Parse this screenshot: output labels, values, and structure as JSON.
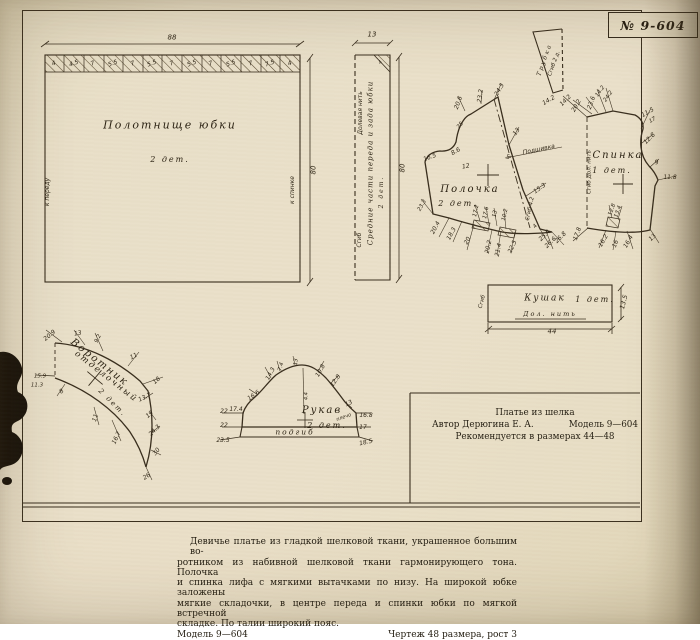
{
  "sheet_no": "№ 9-604",
  "caption": {
    "line1": "Платье из шелка",
    "line2_left": "Автор Дерюгина Е. А.",
    "line2_right": "Модель 9—604",
    "line3": "Рекомендуется в размерах 44—48"
  },
  "footer": {
    "lines": [
      "Девичье платье из гладкой шелковой ткани, украшенное большим во-",
      "ротником из набивной шелковой ткани гармонирующего тона. Полочка",
      "и спинка лифа с мягкими вытачками по низу. На широкой юбке заложены",
      "мягкие складочки, в центре переда и спинки юбки по мягкой встречной",
      "складке. По талии широкий пояс."
    ],
    "model_left": "Модель 9—604",
    "drawing_right": "Чертеж 48 размера, рост 3"
  },
  "colors": {
    "paper": "#e9dfc8",
    "ink": "#372c1c"
  },
  "annotations": [
    {
      "t": "88",
      "x": 172,
      "y": 38,
      "fs": 7,
      "n": "dim-skirt-width"
    },
    {
      "t": "4",
      "x": 54,
      "y": 64,
      "r": -20,
      "fs": 6
    },
    {
      "t": "4.5",
      "x": 74,
      "y": 64,
      "r": -20,
      "fs": 6
    },
    {
      "t": "7",
      "x": 93,
      "y": 64,
      "r": -20,
      "fs": 6
    },
    {
      "t": "5.5",
      "x": 113,
      "y": 64,
      "r": -20,
      "fs": 6
    },
    {
      "t": "7",
      "x": 133,
      "y": 64,
      "r": -20,
      "fs": 6
    },
    {
      "t": "5.5",
      "x": 152,
      "y": 64,
      "r": -20,
      "fs": 6
    },
    {
      "t": "7",
      "x": 172,
      "y": 64,
      "r": -20,
      "fs": 6
    },
    {
      "t": "5.5",
      "x": 192,
      "y": 64,
      "r": -20,
      "fs": 6
    },
    {
      "t": "7",
      "x": 211,
      "y": 64,
      "r": -20,
      "fs": 6
    },
    {
      "t": "5.5",
      "x": 231,
      "y": 64,
      "r": -20,
      "fs": 6
    },
    {
      "t": "7",
      "x": 251,
      "y": 64,
      "r": -20,
      "fs": 6
    },
    {
      "t": "7.5",
      "x": 270,
      "y": 64,
      "r": -20,
      "fs": 6
    },
    {
      "t": "4",
      "x": 290,
      "y": 64,
      "r": -20,
      "fs": 6
    },
    {
      "t": "Полотнище юбки",
      "x": 170,
      "y": 125,
      "fs": 11,
      "c": "pc",
      "n": "piece-skirt-panel"
    },
    {
      "t": "2 дет.",
      "x": 170,
      "y": 160,
      "fs": 8,
      "c": "pc"
    },
    {
      "t": "к переду",
      "x": 48,
      "y": 192,
      "r": -90,
      "fs": 6
    },
    {
      "t": "к спинке",
      "x": 293,
      "y": 190,
      "r": -90,
      "fs": 6
    },
    {
      "t": "80",
      "x": 314,
      "y": 170,
      "r": -90,
      "fs": 7,
      "n": "dim-skirt-length"
    },
    {
      "t": "13",
      "x": 372,
      "y": 35,
      "fs": 7,
      "n": "dim-strip-width"
    },
    {
      "t": "4",
      "x": 381,
      "y": 63,
      "r": -45,
      "fs": 5
    },
    {
      "t": "Долевая нить",
      "x": 361,
      "y": 113,
      "r": -90,
      "fs": 6
    },
    {
      "t": "Сгиб",
      "x": 360,
      "y": 240,
      "r": -90,
      "fs": 6
    },
    {
      "t": "Средние части переда и зада юбки",
      "x": 371,
      "y": 163,
      "r": -90,
      "fs": 7,
      "c": "pc2",
      "n": "piece-skirt-middle"
    },
    {
      "t": "2 дет.",
      "x": 382,
      "y": 192,
      "r": -90,
      "fs": 6,
      "c": "pc"
    },
    {
      "t": "80",
      "x": 403,
      "y": 168,
      "r": -90,
      "fs": 7
    },
    {
      "t": "Полочка",
      "x": 470,
      "y": 190,
      "fs": 10,
      "c": "pc",
      "n": "piece-front-bodice"
    },
    {
      "t": "2 дет.",
      "x": 458,
      "y": 204,
      "fs": 8,
      "c": "pc"
    },
    {
      "t": "20.6",
      "x": 459,
      "y": 103,
      "r": -70,
      "fs": 6
    },
    {
      "t": "23.2",
      "x": 481,
      "y": 96,
      "r": -82,
      "fs": 6
    },
    {
      "t": "24.3",
      "x": 500,
      "y": 90,
      "r": -60,
      "fs": 6
    },
    {
      "t": "25",
      "x": 461,
      "y": 126,
      "r": -50,
      "fs": 5.5
    },
    {
      "t": "8.6",
      "x": 456,
      "y": 152,
      "r": -30,
      "fs": 6
    },
    {
      "t": "16.5",
      "x": 430,
      "y": 158,
      "r": -20,
      "fs": 6
    },
    {
      "t": "12",
      "x": 466,
      "y": 167,
      "r": -10,
      "fs": 6
    },
    {
      "t": "13",
      "x": 517,
      "y": 132,
      "r": -55,
      "fs": 6
    },
    {
      "t": "5",
      "x": 508,
      "y": 158,
      "fs": 6
    },
    {
      "t": "Подшивка",
      "x": 539,
      "y": 150,
      "r": -12,
      "fs": 6,
      "n": "label-hem-facing"
    },
    {
      "t": "15.3",
      "x": 540,
      "y": 189,
      "r": -35,
      "fs": 6
    },
    {
      "t": "Сгиб 4.2",
      "x": 531,
      "y": 209,
      "r": -78,
      "fs": 5.5
    },
    {
      "t": "23.3",
      "x": 423,
      "y": 206,
      "r": -60,
      "fs": 5.5
    },
    {
      "t": "20.4",
      "x": 436,
      "y": 228,
      "r": -62,
      "fs": 6
    },
    {
      "t": "18.3",
      "x": 452,
      "y": 234,
      "r": -62,
      "fs": 6
    },
    {
      "t": "20",
      "x": 468,
      "y": 241,
      "r": -62,
      "fs": 6
    },
    {
      "t": "17.2",
      "x": 477,
      "y": 211,
      "r": -78,
      "fs": 5.5
    },
    {
      "t": "17.6",
      "x": 487,
      "y": 213,
      "r": -78,
      "fs": 5.5
    },
    {
      "t": "13",
      "x": 496,
      "y": 214,
      "r": -78,
      "fs": 5.5
    },
    {
      "t": "10.2",
      "x": 506,
      "y": 215,
      "r": -78,
      "fs": 5.5
    },
    {
      "t": "20.2",
      "x": 489,
      "y": 247,
      "r": -78,
      "fs": 6
    },
    {
      "t": "21.4",
      "x": 499,
      "y": 250,
      "r": -78,
      "fs": 6
    },
    {
      "t": "22.5",
      "x": 513,
      "y": 247,
      "r": -65,
      "fs": 6
    },
    {
      "t": "4",
      "x": 536,
      "y": 227,
      "r": -50,
      "fs": 5.5
    },
    {
      "t": "25.4",
      "x": 545,
      "y": 236,
      "r": -45,
      "fs": 6
    },
    {
      "t": "26.6",
      "x": 551,
      "y": 243,
      "r": -45,
      "fs": 6
    },
    {
      "t": "26.8",
      "x": 561,
      "y": 238,
      "r": -45,
      "fs": 6
    },
    {
      "t": "Трубка",
      "x": 545,
      "y": 60,
      "r": -70,
      "fs": 6,
      "c": "pc",
      "n": "piece-rouleau"
    },
    {
      "t": "Сгиб 2 д.",
      "x": 555,
      "y": 64,
      "r": -70,
      "fs": 5.5
    },
    {
      "t": "14.2",
      "x": 549,
      "y": 101,
      "r": -30,
      "fs": 6
    },
    {
      "t": "14.2",
      "x": 566,
      "y": 101,
      "r": -45,
      "fs": 6
    },
    {
      "t": "20.2",
      "x": 577,
      "y": 106,
      "r": -60,
      "fs": 6
    },
    {
      "t": "23.6",
      "x": 592,
      "y": 103,
      "r": -70,
      "fs": 6
    },
    {
      "t": "14.2",
      "x": 601,
      "y": 92,
      "r": -55,
      "fs": 5.5
    },
    {
      "t": "24.2",
      "x": 609,
      "y": 97,
      "r": -55,
      "fs": 5.5
    },
    {
      "t": "Спинка",
      "x": 618,
      "y": 156,
      "fs": 10,
      "c": "pc",
      "n": "piece-back"
    },
    {
      "t": "1 дет.",
      "x": 612,
      "y": 171,
      "fs": 8,
      "c": "pc"
    },
    {
      "t": "Сгиб  Дол. нить",
      "x": 590,
      "y": 172,
      "r": -90,
      "fs": 5.5
    },
    {
      "t": "11.5",
      "x": 648,
      "y": 113,
      "r": -30,
      "fs": 6
    },
    {
      "t": "17",
      "x": 653,
      "y": 121,
      "r": -30,
      "fs": 5.5
    },
    {
      "t": "12.8",
      "x": 650,
      "y": 139,
      "r": -45,
      "fs": 6
    },
    {
      "t": "9",
      "x": 657,
      "y": 163,
      "r": -15,
      "fs": 6
    },
    {
      "t": "11.8",
      "x": 670,
      "y": 178,
      "fs": 6
    },
    {
      "t": "12.8",
      "x": 613,
      "y": 210,
      "r": -70,
      "fs": 5.5
    },
    {
      "t": "13.4",
      "x": 619,
      "y": 212,
      "r": -70,
      "fs": 5.5
    },
    {
      "t": "17.8",
      "x": 578,
      "y": 234,
      "r": -70,
      "fs": 6
    },
    {
      "t": "16.2",
      "x": 604,
      "y": 241,
      "r": -60,
      "fs": 6
    },
    {
      "t": "16",
      "x": 616,
      "y": 244,
      "r": -70,
      "fs": 6
    },
    {
      "t": "16.4",
      "x": 629,
      "y": 242,
      "r": -60,
      "fs": 6
    },
    {
      "t": "13",
      "x": 653,
      "y": 238,
      "r": -45,
      "fs": 6
    },
    {
      "t": "Кушак",
      "x": 545,
      "y": 299,
      "fs": 9,
      "c": "pc",
      "n": "piece-sash"
    },
    {
      "t": "1 дет.",
      "x": 595,
      "y": 300,
      "fs": 8,
      "c": "pc"
    },
    {
      "t": "Дол. нить",
      "x": 550,
      "y": 314,
      "fs": 6.5,
      "c": "pc",
      "n": "label-grain-line"
    },
    {
      "t": "44",
      "x": 552,
      "y": 332,
      "fs": 7,
      "n": "dim-sash-length"
    },
    {
      "t": "13.5",
      "x": 624,
      "y": 302,
      "r": -75,
      "fs": 6.5,
      "n": "dim-sash-width"
    },
    {
      "t": "Сгиб",
      "x": 483,
      "y": 302,
      "r": -75,
      "fs": 5.5
    },
    {
      "t": "Воротник",
      "x": 99,
      "y": 363,
      "r": 38,
      "fs": 10,
      "c": "pc",
      "n": "piece-collar"
    },
    {
      "t": "отделочный",
      "x": 106,
      "y": 377,
      "r": 38,
      "fs": 8.5,
      "c": "pc"
    },
    {
      "t": "2 дет.",
      "x": 112,
      "y": 403,
      "r": 45,
      "fs": 7,
      "c": "pc"
    },
    {
      "t": "20.9",
      "x": 50,
      "y": 336,
      "r": -40,
      "fs": 6
    },
    {
      "t": "13",
      "x": 78,
      "y": 334,
      "r": -10,
      "fs": 6
    },
    {
      "t": "9.2",
      "x": 99,
      "y": 339,
      "r": -65,
      "fs": 5.5
    },
    {
      "t": "11",
      "x": 134,
      "y": 357,
      "r": -25,
      "fs": 6
    },
    {
      "t": "18",
      "x": 157,
      "y": 381,
      "r": -40,
      "fs": 6
    },
    {
      "t": "13.7",
      "x": 145,
      "y": 398,
      "r": -25,
      "fs": 6
    },
    {
      "t": "19",
      "x": 150,
      "y": 415,
      "r": -40,
      "fs": 6
    },
    {
      "t": "24.3",
      "x": 155,
      "y": 431,
      "r": -45,
      "fs": 6
    },
    {
      "t": "30",
      "x": 157,
      "y": 452,
      "r": -50,
      "fs": 6
    },
    {
      "t": "26",
      "x": 147,
      "y": 477,
      "r": -35,
      "fs": 6
    },
    {
      "t": "15.9",
      "x": 40,
      "y": 377,
      "fs": 5.5
    },
    {
      "t": "11.3",
      "x": 37,
      "y": 386,
      "fs": 5.5
    },
    {
      "t": "8",
      "x": 62,
      "y": 392,
      "r": -35,
      "fs": 6
    },
    {
      "t": "11",
      "x": 96,
      "y": 418,
      "r": -72,
      "fs": 6
    },
    {
      "t": "16.7",
      "x": 117,
      "y": 438,
      "r": -65,
      "fs": 6
    },
    {
      "t": "Рукав",
      "x": 322,
      "y": 411,
      "fs": 10,
      "c": "pc",
      "n": "piece-sleeve"
    },
    {
      "t": "2 дет.",
      "x": 327,
      "y": 426,
      "fs": 8,
      "c": "pc"
    },
    {
      "t": "подгиб",
      "x": 295,
      "y": 432,
      "fs": 7.5,
      "c": "pc",
      "n": "label-hem"
    },
    {
      "t": "14.3",
      "x": 271,
      "y": 374,
      "r": -62,
      "fs": 6
    },
    {
      "t": "7.4",
      "x": 282,
      "y": 367,
      "r": -75,
      "fs": 5.5
    },
    {
      "t": "13",
      "x": 297,
      "y": 362,
      "r": -85,
      "fs": 5.5
    },
    {
      "t": "10.8",
      "x": 321,
      "y": 371,
      "r": -60,
      "fs": 6
    },
    {
      "t": "12.8",
      "x": 336,
      "y": 381,
      "r": -55,
      "fs": 6
    },
    {
      "t": "13",
      "x": 349,
      "y": 404,
      "r": -25,
      "fs": 6
    },
    {
      "t": "16.6",
      "x": 254,
      "y": 396,
      "r": -35,
      "fs": 6
    },
    {
      "t": "17.4",
      "x": 236,
      "y": 410,
      "fs": 6
    },
    {
      "t": "22",
      "x": 224,
      "y": 412,
      "fs": 6
    },
    {
      "t": "22",
      "x": 224,
      "y": 426,
      "fs": 6
    },
    {
      "t": "23.5",
      "x": 223,
      "y": 441,
      "fs": 6
    },
    {
      "t": "плечо",
      "x": 344,
      "y": 418,
      "r": -20,
      "fs": 5
    },
    {
      "t": "16.8",
      "x": 366,
      "y": 416,
      "fs": 6
    },
    {
      "t": "17",
      "x": 363,
      "y": 428,
      "fs": 6
    },
    {
      "t": "18.5",
      "x": 366,
      "y": 443,
      "r": -12,
      "fs": 6
    },
    {
      "t": "4.4",
      "x": 307,
      "y": 396,
      "r": -90,
      "fs": 5
    }
  ]
}
